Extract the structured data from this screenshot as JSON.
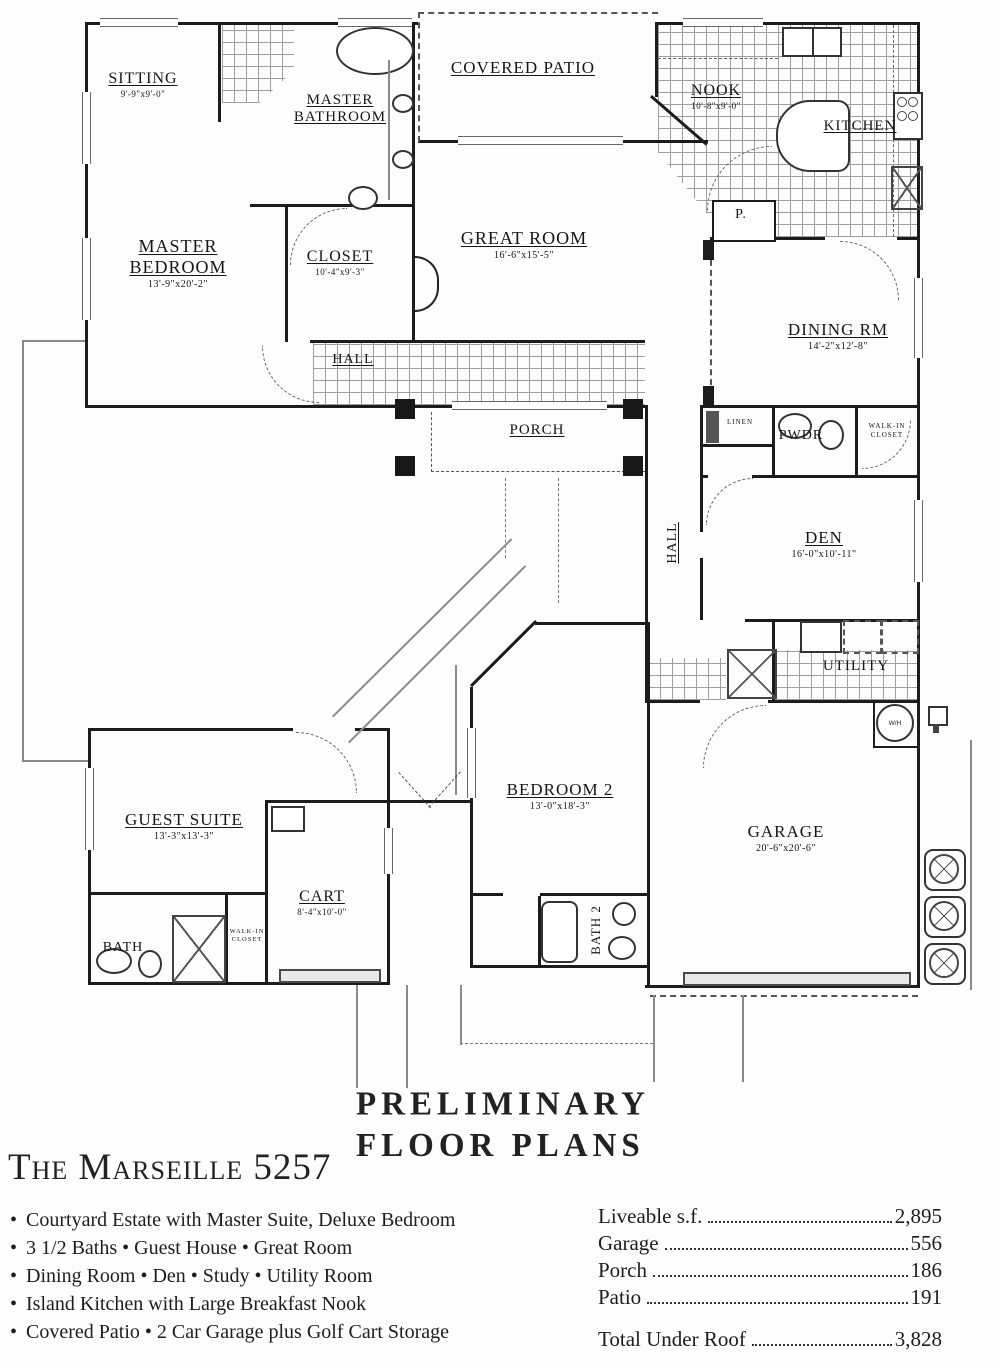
{
  "plan_title": "The Marseille 5257",
  "stamp": {
    "line1": "PRELIMINARY",
    "line2": "FLOOR PLANS"
  },
  "bullet_char": "•",
  "features": [
    "Courtyard Estate with Master Suite, Deluxe Bedroom",
    "3 1/2 Baths • Guest House • Great Room",
    "Dining Room • Den • Study • Utility Room",
    "Island Kitchen with Large Breakfast Nook",
    "Covered Patio • 2 Car Garage plus Golf Cart Storage"
  ],
  "stats": {
    "rows": [
      {
        "label": "Liveable s.f.",
        "value": "2,895"
      },
      {
        "label": "Garage",
        "value": "556"
      },
      {
        "label": "Porch",
        "value": "186"
      },
      {
        "label": "Patio",
        "value": "191"
      }
    ],
    "total_label": "Total Under Roof",
    "total_value": "3,828"
  },
  "rooms": {
    "sitting": {
      "name": "SITTING",
      "dims": "9'-9\"x9'-0\""
    },
    "master_bathroom": {
      "name": "MASTER BATHROOM"
    },
    "master_bedroom": {
      "name": "MASTER BEDROOM",
      "dims": "13'-9\"x20'-2\""
    },
    "closet": {
      "name": "CLOSET",
      "dims": "10'-4\"x9'-3\""
    },
    "covered_patio": {
      "name": "COVERED PATIO"
    },
    "great_room": {
      "name": "GREAT ROOM",
      "dims": "16'-6\"x15'-5\""
    },
    "nook": {
      "name": "NOOK",
      "dims": "10'-8\"x9'-0\""
    },
    "kitchen": {
      "name": "KITCHEN"
    },
    "pantry": {
      "name": "P."
    },
    "dining": {
      "name": "DINING RM",
      "dims": "14'-2\"x12'-8\""
    },
    "hall_main": {
      "name": "HALL"
    },
    "porch": {
      "name": "PORCH"
    },
    "linen": {
      "name": "LINEN"
    },
    "powder": {
      "name": "PWDR"
    },
    "walkin_den": {
      "name": "WALK-IN CLOSET"
    },
    "hall_side": {
      "name": "HALL"
    },
    "den": {
      "name": "DEN",
      "dims": "16'-0\"x10'-11\""
    },
    "utility": {
      "name": "UTILITY"
    },
    "garage": {
      "name": "GARAGE",
      "dims": "20'-6\"x20'-6\""
    },
    "water_heater": {
      "name": "W/H"
    },
    "bedroom2": {
      "name": "BEDROOM 2",
      "dims": "13'-0\"x18'-3\""
    },
    "bath2": {
      "name": "BATH 2"
    },
    "guest_suite": {
      "name": "GUEST SUITE",
      "dims": "13'-3\"x13'-3\""
    },
    "guest_bath": {
      "name": "BATH"
    },
    "guest_walkin": {
      "name": "WALK-IN CLOSET"
    },
    "cart": {
      "name": "CART",
      "dims": "8'-4\"x10'-0\""
    }
  }
}
